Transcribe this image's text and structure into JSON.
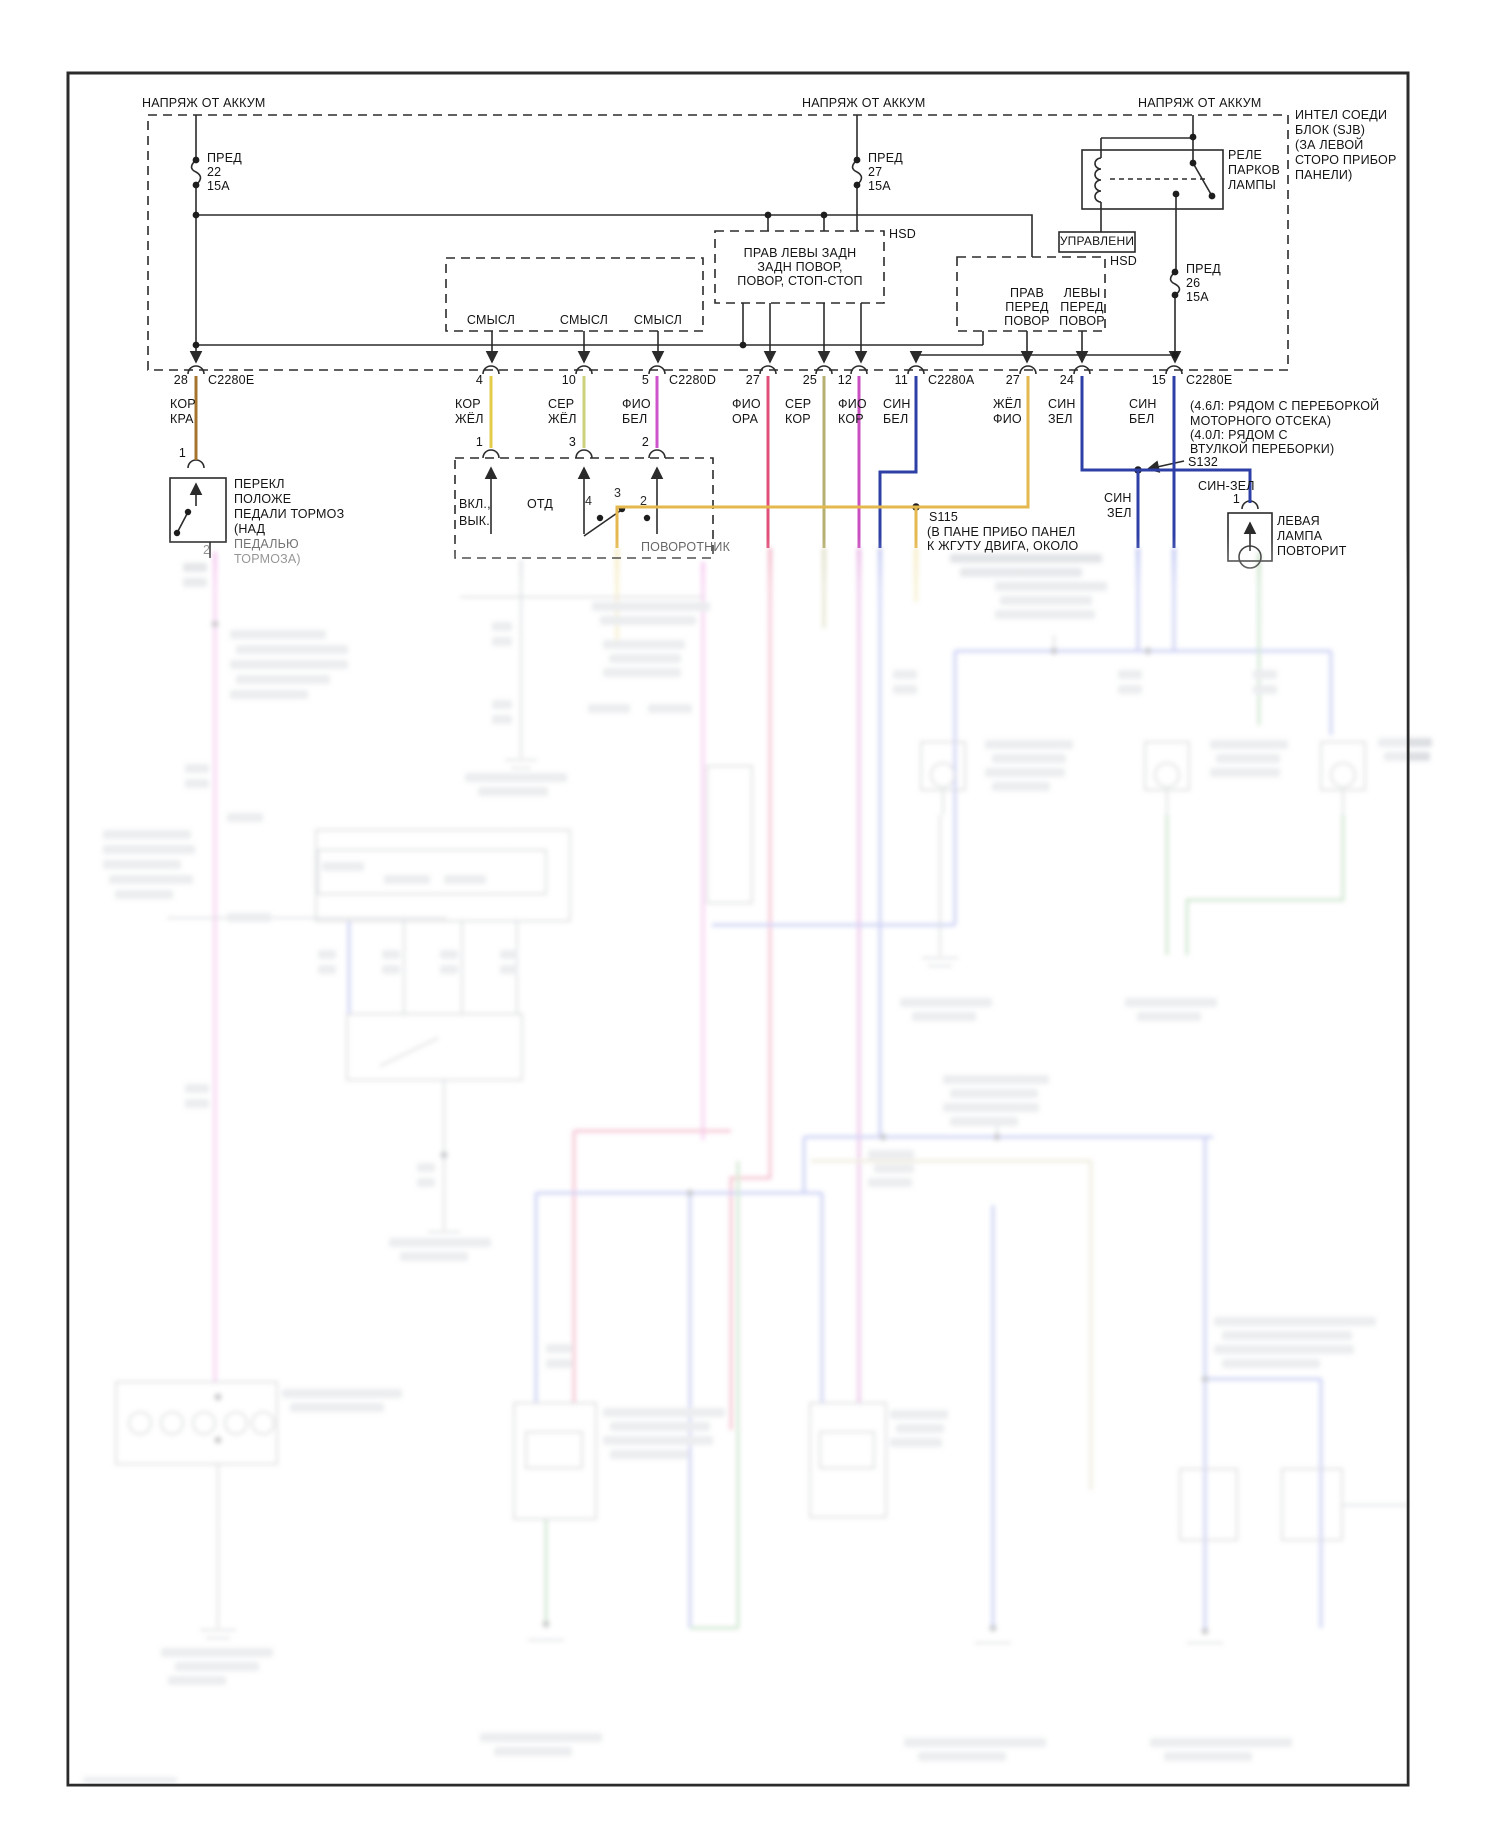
{
  "meta": {
    "kind": "wiring-diagram",
    "language": "ru",
    "sharp_area_bottom_px": 548
  },
  "wire_colors": {
    "kor_kra": "#a5742c",
    "kor_zhel": "#e3cc4a",
    "ser_zhel": "#cdd17b",
    "fio_bel": "#cf54cb",
    "fio_ora": "#e0507a",
    "ser_kor": "#b5af72",
    "fio_kor": "#c94fc0",
    "sin_bel": "#2e3fa5",
    "zhel_fio": "#e4b84e",
    "g_pink": "#e673d8",
    "g_red": "#e0507a",
    "g_blue": "#6a79e0",
    "g_green": "#79b879",
    "g_yellow": "#e8cf6a",
    "g_tan": "#cfc49a"
  },
  "labels": [
    {
      "id": "batt-label-left",
      "t": "НАПРЯЖ ОТ АККУМ",
      "x": 142,
      "y": 97
    },
    {
      "id": "batt-label-mid",
      "t": "НАПРЯЖ ОТ АККУМ",
      "x": 802,
      "y": 97
    },
    {
      "id": "batt-label-right",
      "t": "НАПРЯЖ ОТ АККУМ",
      "x": 1138,
      "y": 97
    },
    {
      "id": "sjb-note-1",
      "t": "ИНТЕЛ СОЕДИ",
      "x": 1295,
      "y": 109
    },
    {
      "id": "sjb-note-2",
      "t": "БЛОК (SJB)",
      "x": 1295,
      "y": 124
    },
    {
      "id": "sjb-note-3",
      "t": "(ЗА ЛЕВОЙ",
      "x": 1295,
      "y": 139
    },
    {
      "id": "sjb-note-4",
      "t": "СТОРО ПРИБОР",
      "x": 1295,
      "y": 154
    },
    {
      "id": "sjb-note-5",
      "t": "ПАНЕЛИ)",
      "x": 1295,
      "y": 169
    },
    {
      "id": "fuse22-name",
      "t": "ПРЕД",
      "x": 207,
      "y": 152
    },
    {
      "id": "fuse22-num",
      "t": "22",
      "x": 207,
      "y": 166
    },
    {
      "id": "fuse22-amp",
      "t": "15А",
      "x": 207,
      "y": 180
    },
    {
      "id": "fuse27-name",
      "t": "ПРЕД",
      "x": 868,
      "y": 152
    },
    {
      "id": "fuse27-num",
      "t": "27",
      "x": 868,
      "y": 166
    },
    {
      "id": "fuse27-amp",
      "t": "15А",
      "x": 868,
      "y": 180
    },
    {
      "id": "relay-name-1",
      "t": "РЕЛЕ",
      "x": 1228,
      "y": 149
    },
    {
      "id": "relay-name-2",
      "t": "ПАРКОВ",
      "x": 1228,
      "y": 164
    },
    {
      "id": "relay-name-3",
      "t": "ЛАМПЫ",
      "x": 1228,
      "y": 179
    },
    {
      "id": "upravleni-label",
      "t": "УПРАВЛЕНИ",
      "x": 1097,
      "y": 235,
      "al": "c",
      "s": 12
    },
    {
      "id": "hsd1-tag",
      "t": "HSD",
      "x": 889,
      "y": 228
    },
    {
      "id": "hsd2-tag",
      "t": "HSD",
      "x": 1110,
      "y": 255
    },
    {
      "id": "hsd1-line-1",
      "t": "ПРАВ ЛЕВЫ ЗАДН",
      "x": 800,
      "y": 247,
      "al": "c"
    },
    {
      "id": "hsd1-line-2",
      "t": "ЗАДН ПОВОР,",
      "x": 800,
      "y": 261,
      "al": "c"
    },
    {
      "id": "hsd1-line-3",
      "t": "ПОВОР, СТОП-СТОП",
      "x": 800,
      "y": 275,
      "al": "c"
    },
    {
      "id": "fuse26-name",
      "t": "ПРЕД",
      "x": 1186,
      "y": 263
    },
    {
      "id": "fuse26-num",
      "t": "26",
      "x": 1186,
      "y": 277
    },
    {
      "id": "fuse26-amp",
      "t": "15А",
      "x": 1186,
      "y": 291
    },
    {
      "id": "hsd2-left-1",
      "t": "ПРАВ",
      "x": 1027,
      "y": 287,
      "al": "c"
    },
    {
      "id": "hsd2-left-2",
      "t": "ПЕРЕД",
      "x": 1027,
      "y": 301,
      "al": "c"
    },
    {
      "id": "hsd2-left-3",
      "t": "ПОВОР",
      "x": 1027,
      "y": 315,
      "al": "c"
    },
    {
      "id": "hsd2-right-1",
      "t": "ЛЕВЫ",
      "x": 1082,
      "y": 287,
      "al": "c"
    },
    {
      "id": "hsd2-right-2",
      "t": "ПЕРЕД",
      "x": 1082,
      "y": 301,
      "al": "c"
    },
    {
      "id": "hsd2-right-3",
      "t": "ПОВОР",
      "x": 1082,
      "y": 315,
      "al": "c"
    },
    {
      "id": "sense-label-1",
      "t": "СМЫСЛ",
      "x": 491,
      "y": 314,
      "al": "c"
    },
    {
      "id": "sense-label-2",
      "t": "СМЫСЛ",
      "x": 584,
      "y": 314,
      "al": "c"
    },
    {
      "id": "sense-label-3",
      "t": "СМЫСЛ",
      "x": 658,
      "y": 314,
      "al": "c"
    },
    {
      "id": "pin-28",
      "t": "28",
      "x": 188,
      "y": 374,
      "al": "r"
    },
    {
      "id": "conn-c2280e-1",
      "t": "C2280E",
      "x": 208,
      "y": 374
    },
    {
      "id": "pin-4",
      "t": "4",
      "x": 483,
      "y": 374,
      "al": "r"
    },
    {
      "id": "pin-10",
      "t": "10",
      "x": 576,
      "y": 374,
      "al": "r"
    },
    {
      "id": "pin-5",
      "t": "5",
      "x": 649,
      "y": 374,
      "al": "r"
    },
    {
      "id": "conn-c2280d",
      "t": "C2280D",
      "x": 669,
      "y": 374
    },
    {
      "id": "pin-27a",
      "t": "27",
      "x": 760,
      "y": 374,
      "al": "r"
    },
    {
      "id": "pin-25",
      "t": "25",
      "x": 817,
      "y": 374,
      "al": "r"
    },
    {
      "id": "pin-12",
      "t": "12",
      "x": 852,
      "y": 374,
      "al": "r"
    },
    {
      "id": "pin-11",
      "t": "11",
      "x": 908,
      "y": 374,
      "al": "r"
    },
    {
      "id": "conn-c2280a",
      "t": "C2280A",
      "x": 928,
      "y": 374
    },
    {
      "id": "pin-27b",
      "t": "27",
      "x": 1020,
      "y": 374,
      "al": "r"
    },
    {
      "id": "pin-24",
      "t": "24",
      "x": 1074,
      "y": 374,
      "al": "r"
    },
    {
      "id": "pin-15",
      "t": "15",
      "x": 1166,
      "y": 374,
      "al": "r"
    },
    {
      "id": "conn-c2280e-2",
      "t": "C2280E",
      "x": 1186,
      "y": 374
    },
    {
      "id": "wlbl-kor-kra-1",
      "t": "КОР",
      "x": 170,
      "y": 398
    },
    {
      "id": "wlbl-kor-kra-2",
      "t": "КРА",
      "x": 170,
      "y": 413
    },
    {
      "id": "wlbl-kor-zhel-1",
      "t": "КОР",
      "x": 455,
      "y": 398
    },
    {
      "id": "wlbl-kor-zhel-2",
      "t": "ЖЁЛ",
      "x": 455,
      "y": 413
    },
    {
      "id": "wlbl-ser-zhel-1",
      "t": "СЕР",
      "x": 548,
      "y": 398
    },
    {
      "id": "wlbl-ser-zhel-2",
      "t": "ЖЁЛ",
      "x": 548,
      "y": 413
    },
    {
      "id": "wlbl-fio-bel-1",
      "t": "ФИО",
      "x": 622,
      "y": 398
    },
    {
      "id": "wlbl-fio-bel-2",
      "t": "БЕЛ",
      "x": 622,
      "y": 413
    },
    {
      "id": "wlbl-fio-ora-1",
      "t": "ФИО",
      "x": 732,
      "y": 398
    },
    {
      "id": "wlbl-fio-ora-2",
      "t": "ОРА",
      "x": 732,
      "y": 413
    },
    {
      "id": "wlbl-ser-kor-1",
      "t": "СЕР",
      "x": 785,
      "y": 398
    },
    {
      "id": "wlbl-ser-kor-2",
      "t": "КОР",
      "x": 785,
      "y": 413
    },
    {
      "id": "wlbl-fio-kor-1",
      "t": "ФИО",
      "x": 838,
      "y": 398
    },
    {
      "id": "wlbl-fio-kor-2",
      "t": "КОР",
      "x": 838,
      "y": 413
    },
    {
      "id": "wlbl-sin-bel-1",
      "t": "СИН",
      "x": 883,
      "y": 398
    },
    {
      "id": "wlbl-sin-bel-2",
      "t": "БЕЛ",
      "x": 883,
      "y": 413
    },
    {
      "id": "wlbl-zhel-fio-1",
      "t": "ЖЁЛ",
      "x": 993,
      "y": 398
    },
    {
      "id": "wlbl-zhel-fio-2",
      "t": "ФИО",
      "x": 993,
      "y": 413
    },
    {
      "id": "wlbl-sin-zel-1",
      "t": "СИН",
      "x": 1048,
      "y": 398
    },
    {
      "id": "wlbl-sin-zel-2",
      "t": "ЗЕЛ",
      "x": 1048,
      "y": 413
    },
    {
      "id": "wlbl-sin-bel2-1",
      "t": "СИН",
      "x": 1129,
      "y": 398
    },
    {
      "id": "wlbl-sin-bel2-2",
      "t": "БЕЛ",
      "x": 1129,
      "y": 413
    },
    {
      "id": "brake-pin-1",
      "t": "1",
      "x": 186,
      "y": 447,
      "al": "r"
    },
    {
      "id": "brake-name-1",
      "t": "ПЕРЕКЛ",
      "x": 234,
      "y": 478
    },
    {
      "id": "brake-name-2",
      "t": "ПОЛОЖЕ",
      "x": 234,
      "y": 493
    },
    {
      "id": "brake-name-3",
      "t": "ПЕДАЛИ ТОРМОЗ",
      "x": 234,
      "y": 508
    },
    {
      "id": "brake-name-4",
      "t": "(НАД",
      "x": 234,
      "y": 523
    },
    {
      "id": "brake-name-5",
      "t": "ПЕДАЛЬЮ",
      "x": 234,
      "y": 538,
      "o": 0.6
    },
    {
      "id": "brake-name-6",
      "t": "ТОРМОЗА)",
      "x": 234,
      "y": 553,
      "o": 0.45
    },
    {
      "id": "brake-pin-2",
      "t": "2",
      "x": 203,
      "y": 544,
      "o": 0.45
    },
    {
      "id": "turn-pin-1",
      "t": "1",
      "x": 483,
      "y": 436,
      "al": "r"
    },
    {
      "id": "turn-pin-3",
      "t": "3",
      "x": 576,
      "y": 436,
      "al": "r"
    },
    {
      "id": "turn-pin-2",
      "t": "2",
      "x": 649,
      "y": 436,
      "al": "r"
    },
    {
      "id": "turn-vkl",
      "t": "ВКЛ.,",
      "x": 459,
      "y": 498
    },
    {
      "id": "turn-vyk",
      "t": "ВЫК.",
      "x": 459,
      "y": 515
    },
    {
      "id": "turn-otd",
      "t": "ОТД",
      "x": 527,
      "y": 498
    },
    {
      "id": "turn-contact-4",
      "t": "4",
      "x": 585,
      "y": 495,
      "o": 0.9
    },
    {
      "id": "turn-contact-3",
      "t": "3",
      "x": 614,
      "y": 487,
      "o": 0.9
    },
    {
      "id": "turn-contact-2",
      "t": "2",
      "x": 640,
      "y": 495,
      "o": 0.9
    },
    {
      "id": "turn-name",
      "t": "ПОВОРОТНИК",
      "x": 641,
      "y": 541,
      "o": 0.65
    },
    {
      "id": "s115-id",
      "t": "S115",
      "x": 929,
      "y": 511
    },
    {
      "id": "s115-note-1",
      "t": "(В ПАНЕ ПРИБО ПАНЕЛ",
      "x": 927,
      "y": 526
    },
    {
      "id": "s115-note-2",
      "t": "К ЖГУТУ ДВИГА, ОКОЛО",
      "x": 927,
      "y": 540
    },
    {
      "id": "s132-note-1",
      "t": "(4.6Л: РЯДОМ С ПЕРЕБОРКОЙ",
      "x": 1190,
      "y": 400
    },
    {
      "id": "s132-note-2",
      "t": "МОТОРНОГО ОТСЕКА)",
      "x": 1190,
      "y": 415
    },
    {
      "id": "s132-note-3",
      "t": "(4.0Л: РЯДОМ С",
      "x": 1190,
      "y": 429
    },
    {
      "id": "s132-note-4",
      "t": "ВТУЛКОЙ ПЕРЕБОРКИ)",
      "x": 1190,
      "y": 443
    },
    {
      "id": "s132-id",
      "t": "S132",
      "x": 1188,
      "y": 456
    },
    {
      "id": "sin-zel-inline",
      "t": "СИН-ЗЕЛ",
      "x": 1198,
      "y": 480
    },
    {
      "id": "sin-zel-stub-1",
      "t": "СИН",
      "x": 1104,
      "y": 492
    },
    {
      "id": "sin-zel-stub-2",
      "t": "ЗЕЛ",
      "x": 1107,
      "y": 507
    },
    {
      "id": "lamp-pin-1",
      "t": "1",
      "x": 1240,
      "y": 493,
      "al": "r"
    },
    {
      "id": "lamp-name-1",
      "t": "ЛЕВАЯ",
      "x": 1277,
      "y": 515
    },
    {
      "id": "lamp-name-2",
      "t": "ЛАМПА",
      "x": 1277,
      "y": 530
    },
    {
      "id": "lamp-name-3",
      "t": "ПОВТОРИТ",
      "x": 1277,
      "y": 545
    }
  ]
}
